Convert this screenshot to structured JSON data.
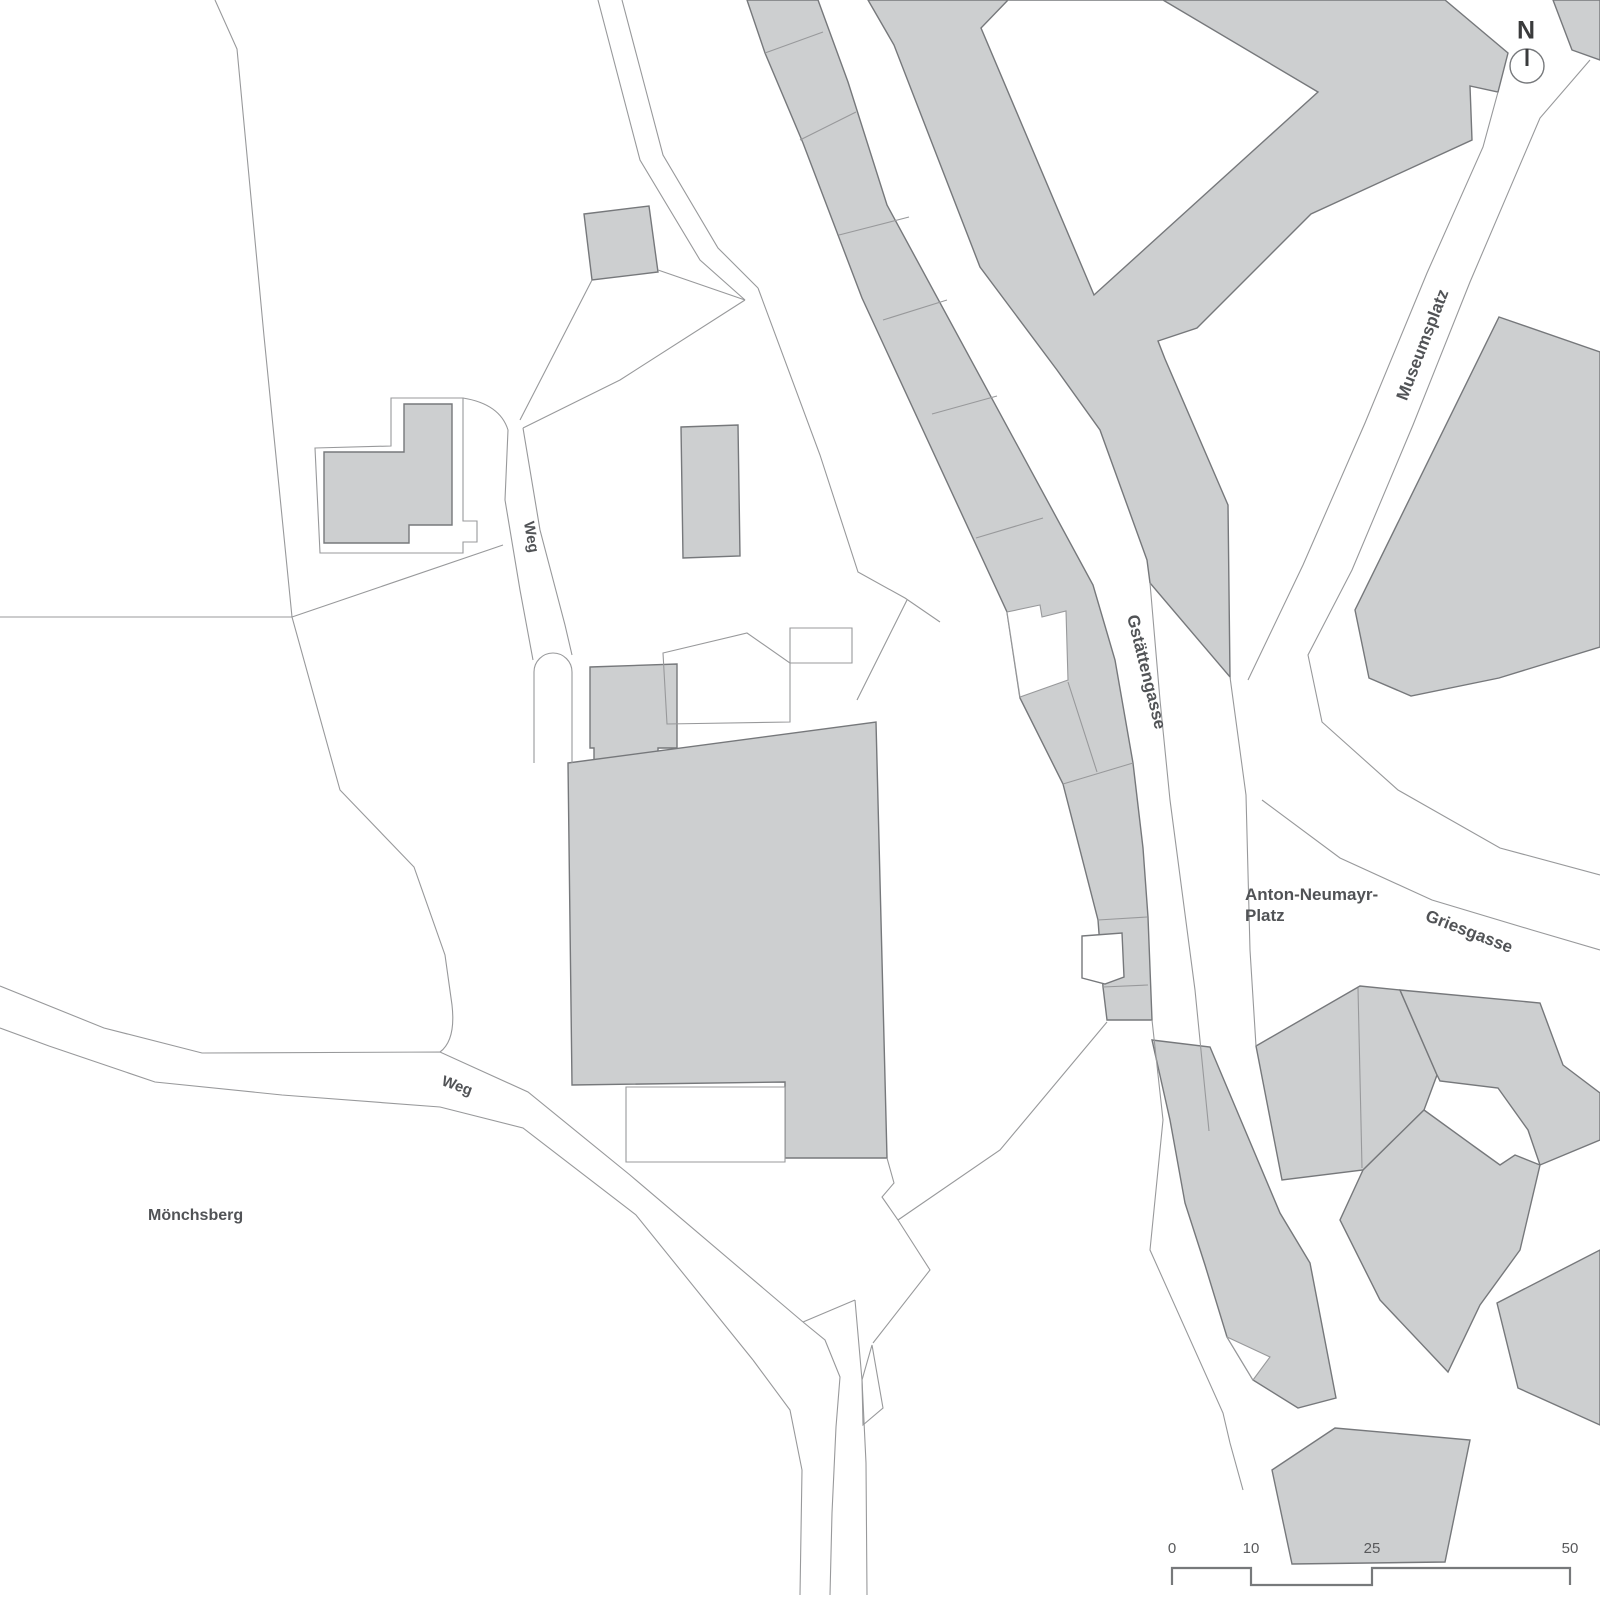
{
  "title": "Site plan",
  "colors": {
    "background": "#ffffff",
    "building_fill": "#cdcfd0",
    "building_stroke": "#76787b",
    "parcel_stroke": "#98999b",
    "label_color": "#515356",
    "scale_color": "#77797b",
    "north_color": "#3a3b3c"
  },
  "labels": {
    "museumsplatz": "Museumsplatz",
    "gstaettengasse": "Gstättengasse",
    "weg_top": "Weg",
    "weg_bottom": "Weg",
    "anton_line1": "Anton-Neumayr-",
    "anton_line2": "Platz",
    "griesgasse": "Griesgasse",
    "moenchsberg": "Mönchsberg",
    "north": "N",
    "scale": [
      "0",
      "10",
      "25",
      "50"
    ]
  },
  "map": {
    "buildings": [
      {
        "name": "building-small-square",
        "d": "M584,214 L649,206 L658,272 L592,280 Z"
      },
      {
        "name": "building-l-shaped",
        "d": "M324,452 L404,452 L404,404 L452,404 L452,525 L409,525 L409,543 L324,543 Z"
      },
      {
        "name": "building-rect-center",
        "d": "M681,427 L738,425 L740,556 L683,558 Z"
      },
      {
        "name": "building-annex-tower",
        "d": "M590,667 L677,664 L677,748 L658,748 L658,778 L612,778 L612,771 L594,771 L594,748 L590,748 Z"
      },
      {
        "name": "building-main-hall",
        "d": "M568,763 L876,722 L887,1158 L785,1158 L785,1082 L572,1085 Z"
      },
      {
        "name": "building-v-complex",
        "d": "M868,0 L1245,0 L1445,0 L1508,53 L1498,92 L1470,86 L1472,140 L1311,214 L1197,328 L1158,341 L1165,359 L1228,505 L1230,677 L1150,583 L1147,560 L1100,430 L1057,370 L980,267 L894,45 Z"
      },
      {
        "name": "building-west-row",
        "d": "M747,0 L818,0 L848,82 L887,205 L1093,585 L1115,660 L1133,763 L1143,848 L1148,917 L1152,1020 L1107,1020 L1103,987 L1098,920 L1063,784 L1020,698 L1007,612 L862,298 L803,143 L765,53 Z"
      },
      {
        "name": "building-mid-strip",
        "d": "M1152,1040 L1210,1047 L1280,1213 L1310,1263 L1336,1398 L1298,1408 L1253,1380 L1227,1337 L1205,1265 L1185,1203 L1170,1120 Z"
      },
      {
        "name": "building-block-a",
        "d": "M1256,1046 L1360,986 L1400,990 L1437,1075 L1424,1110 L1363,1170 L1282,1180 Z"
      },
      {
        "name": "building-block-b",
        "d": "M1400,990 L1540,1003 L1563,1065 L1600,1093 L1600,1140 L1540,1165 L1528,1130 L1498,1088 L1440,1081 L1437,1075 Z"
      },
      {
        "name": "building-block-c",
        "d": "M1424,1110 L1475,1147 L1500,1165 L1515,1155 L1540,1165 L1520,1250 L1480,1305 L1448,1372 L1380,1300 L1340,1220 L1363,1170 Z"
      },
      {
        "name": "building-block-e",
        "d": "M1272,1470 L1335,1428 L1470,1440 L1445,1562 L1292,1564 Z"
      },
      {
        "name": "building-block-f",
        "d": "M1497,1303 L1600,1250 L1600,1425 L1518,1388 Z"
      },
      {
        "name": "building-corner-ne",
        "d": "M1553,0 L1600,0 L1600,60 L1572,50 Z"
      },
      {
        "name": "building-east-large",
        "d": "M1499,317 L1600,352 L1600,647 L1499,678 L1411,696 L1369,678 L1355,610 Z"
      }
    ],
    "overlays": [
      {
        "name": "courtyard-triangle",
        "stroke": "building",
        "d": "M1008,0 L1163,0 L1318,92 L1094,295 L981,28 Z"
      },
      {
        "name": "gap-parcel-white",
        "stroke": "parcel",
        "d": "M1007,612 L1040,605 L1042,617 L1066,611 L1068,680 L1020,697 Z"
      },
      {
        "name": "white-building",
        "stroke": "building",
        "d": "M1082,936 L1122,933 L1124,977 L1105,984 L1082,978 Z"
      },
      {
        "name": "notch-parcel",
        "stroke": "parcel",
        "d": "M626,1087 L785,1087 L785,1162 L626,1162 Z"
      },
      {
        "name": "sliver-white",
        "stroke": "parcel",
        "d": "M1227,1337 L1270,1357 L1253,1380 Z"
      }
    ],
    "outlines": [
      {
        "name": "l-building-parcel",
        "d": "M315,448 L391,446 L391,398 L463,398 L463,521 L477,521 L477,542 L463,542 L463,553 L320,553 Z"
      },
      {
        "name": "roof-parcel",
        "d": "M663,653 L747,633 L790,663 L790,722 L667,724 Z"
      },
      {
        "name": "small-rect-parcel",
        "d": "M790,628 L852,628 L852,663 L790,663 Z"
      },
      {
        "name": "wedge-parcel",
        "d": "M872,1345 L883,1408 L863,1425 L862,1380 Z"
      }
    ],
    "lines": [
      {
        "name": "boundary-long-west",
        "d": "M215,0 L237,49 L264,336 L292,617 L340,790 L414,867 L445,955 L452,1005 Q456,1040 440,1052"
      },
      {
        "name": "boundary-horizontal",
        "d": "M0,617 L292,617"
      },
      {
        "name": "boundary-diag",
        "d": "M503,545 L292,617"
      },
      {
        "name": "weg-path-north",
        "d": "M0,986 L104,1028 L202,1053 L440,1052 L528,1092 L630,1175 L803,1322"
      },
      {
        "name": "weg-path-south",
        "d": "M0,1028 L49,1046 L155,1082 L282,1095 L440,1107 L523,1128 L636,1215 L753,1360"
      },
      {
        "name": "path-bottom-1",
        "d": "M803,1322 L825,1340 L840,1377 L836,1427 L832,1513 L830,1595"
      },
      {
        "name": "path-bottom-2",
        "d": "M753,1360 L790,1410 L802,1470 L800,1595"
      },
      {
        "name": "path-bottom-3",
        "d": "M855,1300 L862,1380 L866,1463 L867,1595"
      },
      {
        "name": "path-bottom-4",
        "d": "M803,1322 L855,1300"
      },
      {
        "name": "zigzag-se-corner",
        "d": "M887,1158 L894,1183 L882,1197 L898,1220 L930,1270 L873,1343"
      },
      {
        "name": "diag-to-street",
        "d": "M898,1220 L1000,1150 L1107,1022"
      },
      {
        "name": "lane-top-west",
        "d": "M598,0 L640,160 L700,260 L745,300"
      },
      {
        "name": "lane-top-east",
        "d": "M622,0 L663,155 L718,248 L758,288"
      },
      {
        "name": "lane-to-weg",
        "d": "M745,300 L620,380 L523,428"
      },
      {
        "name": "parcel-b1-sw",
        "d": "M592,280 L520,420"
      },
      {
        "name": "parcel-b1-se",
        "d": "M658,270 L745,300"
      },
      {
        "name": "weg-vert-west",
        "d": "M463,398 Q500,404 508,430 L505,500 L520,590 L533,660"
      },
      {
        "name": "weg-vert-east",
        "d": "M523,428 L540,530 L565,625 L572,655"
      },
      {
        "name": "lane-stub-rounded",
        "d": "M534,763 L534,672 A19,19 0 0 1 572,672 L572,763"
      },
      {
        "name": "parcel-triangle-east",
        "d": "M758,288 L820,455 L858,572 L905,598 L940,622"
      },
      {
        "name": "parcel-diag-ne",
        "d": "M907,600 L857,700"
      },
      {
        "name": "museumsplatz-west",
        "d": "M1498,92 L1483,147 L1427,273 L1365,423 L1303,565 L1248,680"
      },
      {
        "name": "museumsplatz-east",
        "d": "M1590,60 L1540,118 L1470,282 L1413,425 L1352,570 L1308,655 L1322,722 L1398,790 L1500,848 L1600,875"
      },
      {
        "name": "griesgasse-south",
        "d": "M1262,800 L1340,858 L1432,900 L1532,930 L1600,950"
      },
      {
        "name": "gstaettengasse-east",
        "d": "M1150,583 L1160,700 L1170,800 L1195,990 L1209,1131"
      },
      {
        "name": "gstaettengasse-west-lower",
        "d": "M1152,1020 L1163,1120 L1150,1250 L1223,1413 L1230,1443 L1243,1490"
      },
      {
        "name": "platz-west-line",
        "d": "M1230,677 L1246,795 L1250,950 L1256,1046"
      },
      {
        "name": "row-division-1",
        "d": "M765,53 L823,32"
      },
      {
        "name": "row-division-2",
        "d": "M800,140 L856,112"
      },
      {
        "name": "row-division-3",
        "d": "M839,235 L909,217"
      },
      {
        "name": "row-division-4",
        "d": "M883,320 L947,300"
      },
      {
        "name": "row-division-5",
        "d": "M932,414 L997,396"
      },
      {
        "name": "row-division-6",
        "d": "M976,538 L1043,518"
      },
      {
        "name": "row-division-7",
        "d": "M1063,784 L1133,763"
      },
      {
        "name": "row-division-8",
        "d": "M1098,920 L1147,917"
      },
      {
        "name": "row-division-9",
        "d": "M1103,987 L1148,985"
      },
      {
        "name": "row-division-10",
        "d": "M1068,682 L1097,772"
      },
      {
        "name": "block-a-division",
        "d": "M1358,988 L1362,1168"
      }
    ],
    "north": {
      "cx": 1527,
      "cy": 66,
      "r": 17,
      "needle": "M1527,49 L1527,66"
    },
    "scalebar_path": "M1172,1585 L1172,1568 L1251,1568 L1251,1585 L1372,1585 L1372,1568 L1570,1568 L1570,1585",
    "scale_positions": [
      1172,
      1251,
      1372,
      1570
    ]
  }
}
